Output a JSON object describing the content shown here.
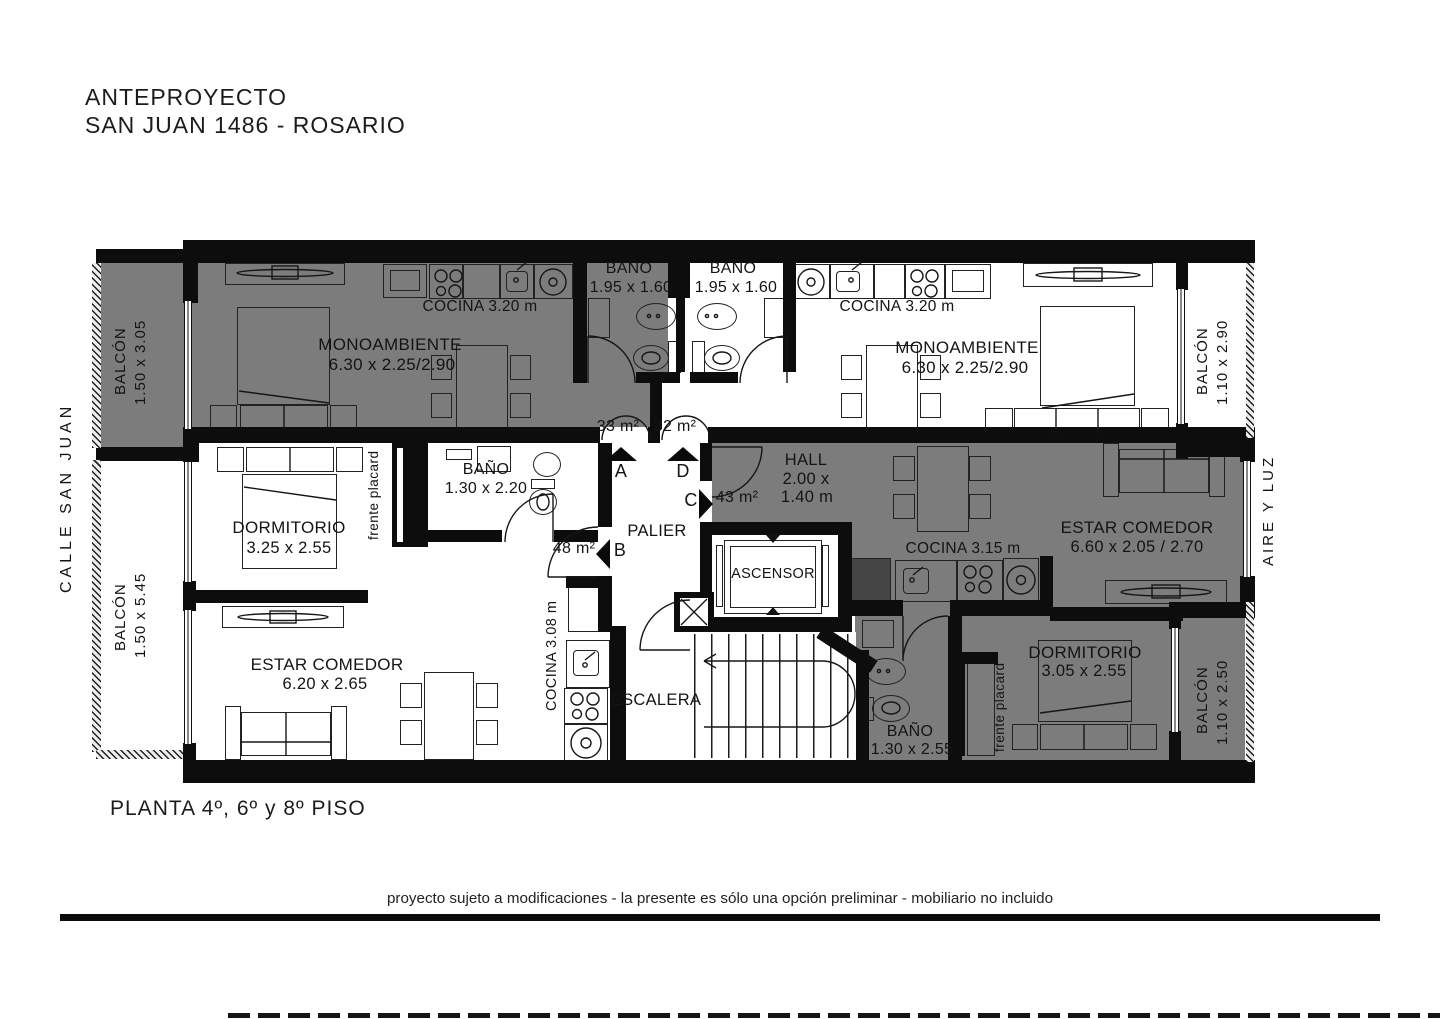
{
  "title": {
    "line1": "ANTEPROYECTO",
    "line2": "SAN JUAN 1486 - ROSARIO"
  },
  "surroundings": {
    "street": "CALLE SAN JUAN",
    "air_light": "AIRE Y LUZ"
  },
  "footer": {
    "floor_label": "PLANTA 4º, 6º y 8º PISO",
    "disclaimer": "proyecto sujeto a modificaciones - la presente es sólo una opción preliminar - mobiliario no incluido"
  },
  "core": {
    "palier": "PALIER",
    "ascensor": "ASCENSOR",
    "escalera": "ESCALERA"
  },
  "balconies": {
    "top_left": {
      "label": "BALCÓN",
      "dims": "1.50 x 3.05"
    },
    "bottom_left": {
      "label": "BALCÓN",
      "dims": "1.50 x 5.45"
    },
    "top_right": {
      "label": "BALCÓN",
      "dims": "1.10 x 2.90"
    },
    "bottom_right": {
      "label": "BALCÓN",
      "dims": "1.10 x 2.50"
    }
  },
  "unit_a": {
    "entry": "A",
    "area": "33 m²",
    "room": "MONOAMBIENTE",
    "room_dims": "6.30 x 2.25/2.90",
    "kitchen": "COCINA 3.20 m",
    "bath": "BAÑO",
    "bath_dims": "1.95 x 1.60"
  },
  "unit_d": {
    "entry": "D",
    "area": "32 m²",
    "room": "MONOAMBIENTE",
    "room_dims": "6.30 x 2.25/2.90",
    "kitchen": "COCINA 3.20 m",
    "bath": "BAÑO",
    "bath_dims": "1.95 x 1.60"
  },
  "unit_b": {
    "entry": "B",
    "area": "48 m²",
    "bedroom": "DORMITORIO",
    "bedroom_dims": "3.25 x 2.55",
    "living": "ESTAR COMEDOR",
    "living_dims": "6.20 x 2.65",
    "kitchen": "COCINA 3.08 m",
    "bath": "BAÑO",
    "bath_dims": "1.30 x 2.20",
    "placard": "frente placard"
  },
  "unit_c": {
    "entry": "C",
    "area": "43 m²",
    "hall": "HALL",
    "hall_dims_1": "2.00 x",
    "hall_dims_2": "1.40 m",
    "kitchen": "COCINA 3.15 m",
    "living": "ESTAR COMEDOR",
    "living_dims": "6.60 x 2.05 / 2.70",
    "bedroom": "DORMITORIO",
    "bedroom_dims": "3.05 x 2.55",
    "bath": "BAÑO",
    "bath_dims": "1.30 x 2.55",
    "placard": "frente placard"
  }
}
